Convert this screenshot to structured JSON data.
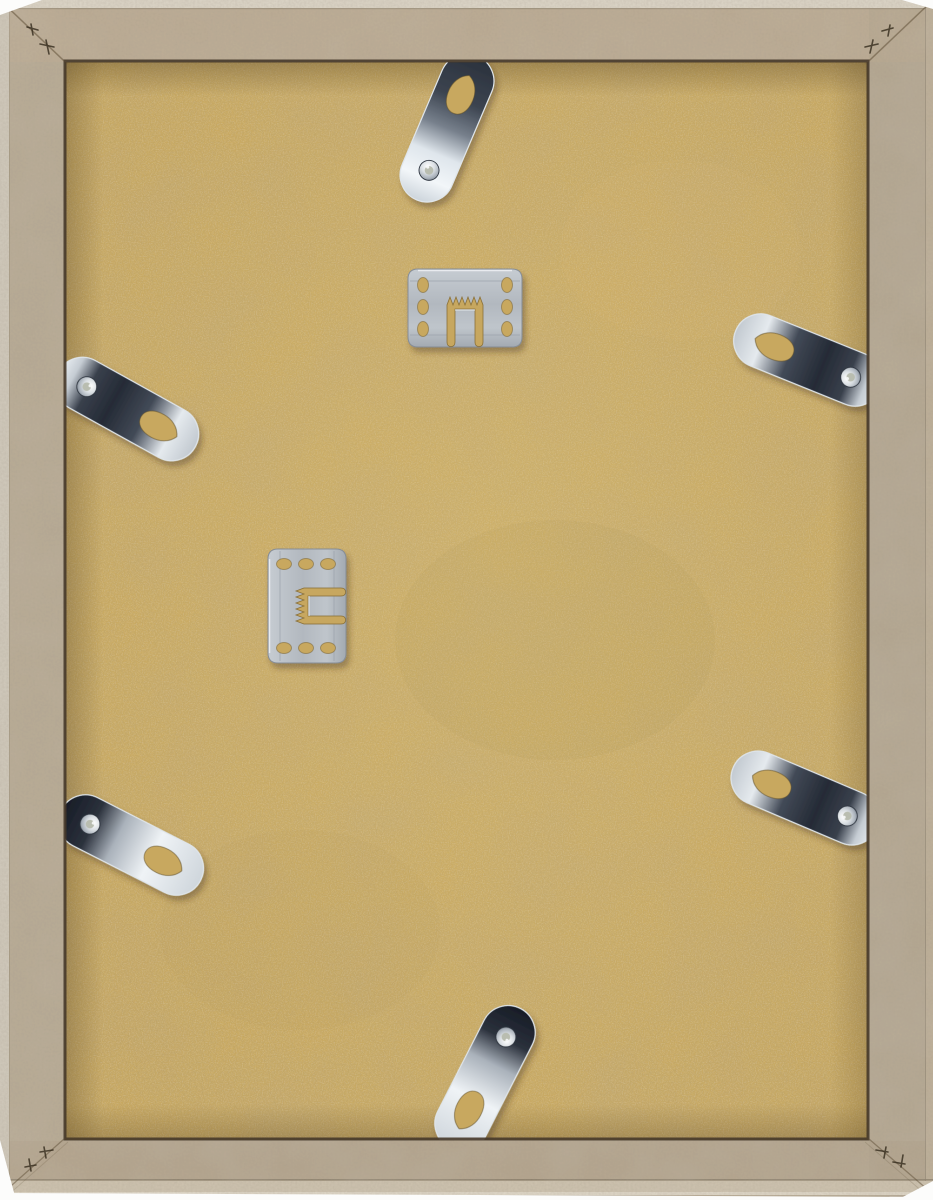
{
  "scene": {
    "type": "photograph",
    "subject": "Back of an empty wooden picture frame with MDF backing board, six chrome flexi-tab clips and two sawtooth hanger plates",
    "background_color": "#fcfcfb"
  },
  "frame": {
    "material": "raw wood moulding with mitred corners and v-nail marks",
    "face_color": "#b7aa94",
    "edge_highlight_color": "#dcd5c7",
    "seam_color": "#46392a",
    "border_px": {
      "top": 62,
      "left": 65,
      "right": 65,
      "bottom": 60
    }
  },
  "backing": {
    "material": "MDF board",
    "color": "#c9a960",
    "center_highlight_color": "#e9d28a",
    "edge_shadow_color": "#5e4a24"
  },
  "hardware": {
    "hanger_color": "#b6bcc3",
    "tab_chrome_bright": "#eef2f6",
    "tab_chrome_dark": "#232933",
    "hangers": [
      {
        "id": "sawtooth-hanger-top",
        "x": 408,
        "y": 269,
        "rotation": 0
      },
      {
        "id": "sawtooth-hanger-left",
        "x": 268,
        "y": 663,
        "rotation": -90
      }
    ],
    "tabs": [
      {
        "id": "flexi-tab-top",
        "cx": 447,
        "cy": 128,
        "rotation": 23,
        "finish": "chromeA"
      },
      {
        "id": "flexi-tab-left",
        "cx": 127,
        "cy": 409,
        "rotation": 119,
        "finish": "chromeB"
      },
      {
        "id": "flexi-tab-right-upper",
        "cx": 808,
        "cy": 360,
        "rotation": -68,
        "finish": "chromeB"
      },
      {
        "id": "flexi-tab-bottom-left",
        "cx": 131,
        "cy": 845,
        "rotation": 117,
        "finish": "chromeC"
      },
      {
        "id": "flexi-tab-bottom-right",
        "cx": 805,
        "cy": 798,
        "rotation": -67,
        "finish": "chromeB"
      },
      {
        "id": "flexi-tab-bottom",
        "cx": 485,
        "cy": 1078,
        "rotation": -153,
        "finish": "chromeC"
      }
    ]
  }
}
